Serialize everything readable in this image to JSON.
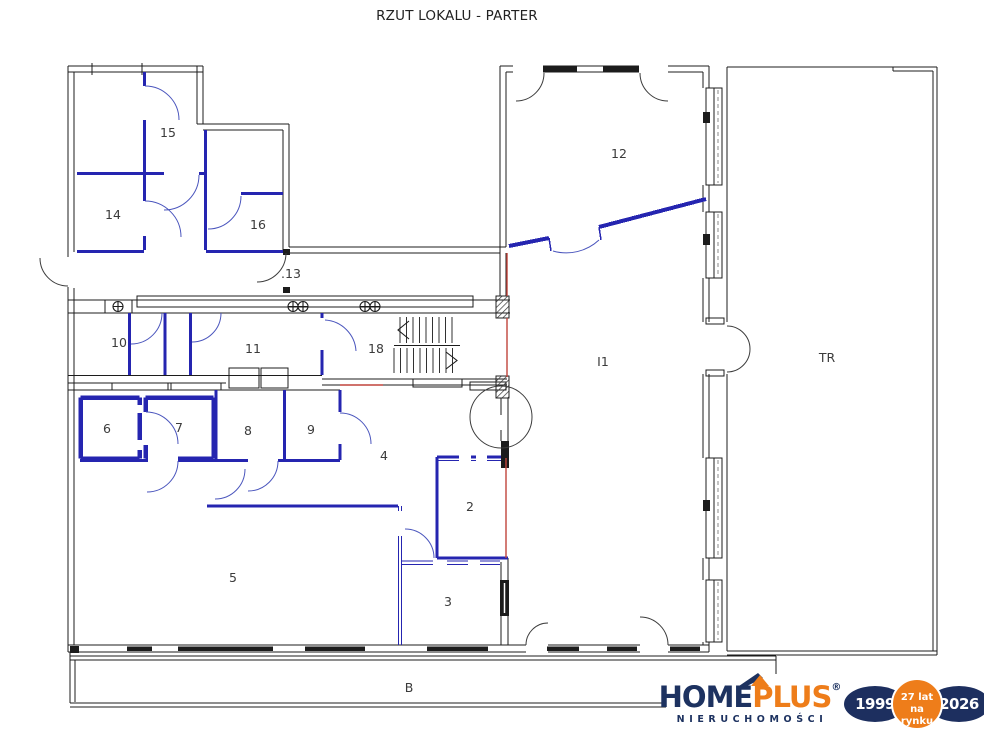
{
  "title": "RZUT LOKALU - PARTER",
  "plan": {
    "room_labels": {
      "r15": "15",
      "r14": "14",
      "r16": "16",
      "r13": ".13",
      "r10": "10",
      "r11": "11",
      "r18": "18",
      "r12": "12",
      "r6": "6",
      "r7": "7",
      "r8": "8",
      "r9": "9",
      "r4": "4",
      "r2": "2",
      "r3": "3",
      "r5": "5",
      "hall": "I1",
      "tr": "TR",
      "balcony": "B"
    },
    "colors": {
      "wall": "#1c1c1c",
      "partition": "#2525b0",
      "door_arc": "#4a55bd",
      "marker_line": "#c0443c"
    }
  },
  "logo": {
    "brand_home": "HOME",
    "brand_plus": "PLUS",
    "registered": "®",
    "subtitle": "NIERUCHOMOŚCI",
    "badges": {
      "start_year": "1999",
      "center_line1": "27 lat",
      "center_line2": "na rynku",
      "end_year": "2026"
    },
    "colors": {
      "navy": "#1d3260",
      "orange": "#ee7d1a"
    }
  }
}
